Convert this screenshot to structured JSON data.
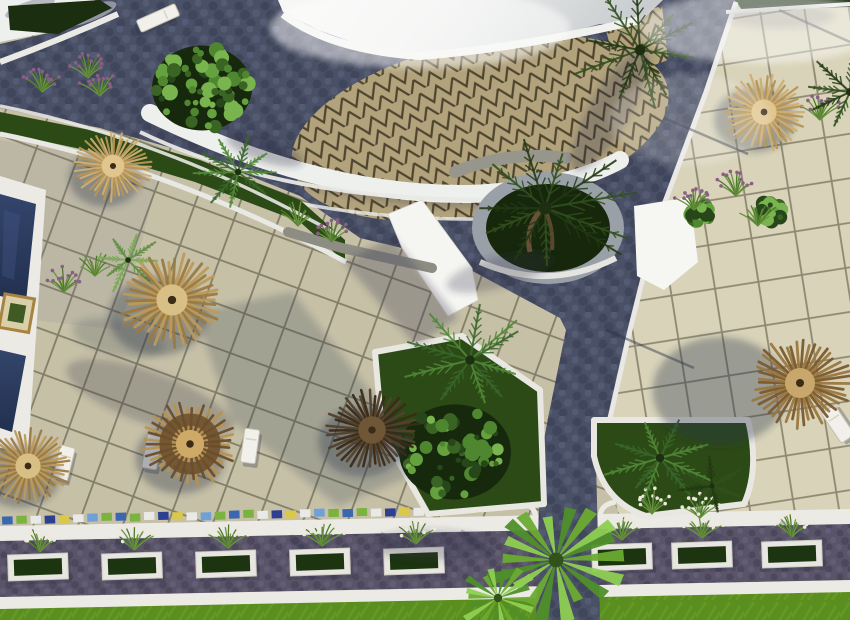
{
  "scene": {
    "title": "Aerial 3D architectural rendering of a resort courtyard with swimming pool, thatched palapa umbrellas, sun loungers, palm trees, tiled terraces, cobblestone paths and planted walkway",
    "type": "3d-architectural-render",
    "view": "aerial top-down",
    "canvas": {
      "width": 850,
      "height": 620
    }
  },
  "palette": {
    "sky_white": "#f7f7f5",
    "sky_gray": "#c6cacd",
    "tile_left": "#c6c0a7",
    "tile_right": "#d8d3b9",
    "tile_line": "#6b6651",
    "tile_line_right": "#7c7660",
    "cobble": "#4a5065",
    "cobble_dark": "#3c4257",
    "cobble_light": "#5d647f",
    "walkway": "#5a5468",
    "walkway_dark": "#49435a",
    "walkway_light": "#6a6480",
    "white_trim": "#eceae5",
    "zigzag_base": "#b2a37c",
    "zigzag_line": "#4e452f",
    "pool_water": "#2e4066",
    "pool_water_deep": "#22304f",
    "lawn": "#5a8e1e",
    "lawn_light": "#6ba42c",
    "bed_green": "#2c4a16",
    "bed_dark": "#16270c",
    "hedge": "#1b2e0f",
    "stone": "#97968d",
    "shadow": "#2a3048"
  },
  "objects": {
    "umbrella_tones": {
      "light": {
        "spokes": [
          "#cfae72",
          "#b69554"
        ],
        "hub": "#e0c58d"
      },
      "tan": {
        "spokes": [
          "#bd9a58",
          "#9a7a42"
        ],
        "hub": "#d8bf86"
      },
      "tanRing": {
        "spokes": [
          "#b8924f",
          "#6b4e2a"
        ],
        "hub": "#cfa968",
        "ring": true
      },
      "brown": {
        "spokes": [
          "#9a773f",
          "#7a5a2e"
        ],
        "hub": "#c8a76c"
      },
      "dark": {
        "spokes": [
          "#53412a",
          "#3a2b18"
        ],
        "hub": "#6e5636"
      }
    },
    "umbrellas": [
      {
        "x": 113,
        "y": 166,
        "r": 38,
        "tone": "light",
        "sx": -8,
        "sy": 12
      },
      {
        "x": 172,
        "y": 300,
        "r": 52,
        "tone": "tan",
        "sx": -14,
        "sy": 16
      },
      {
        "x": 28,
        "y": 466,
        "r": 42,
        "tone": "tan",
        "sx": -8,
        "sy": 10
      },
      {
        "x": 190,
        "y": 444,
        "r": 47,
        "tone": "tanRing",
        "sx": -10,
        "sy": 14
      },
      {
        "x": 372,
        "y": 430,
        "r": 46,
        "tone": "dark",
        "sx": -10,
        "sy": 12
      },
      {
        "x": 800,
        "y": 383,
        "r": 50,
        "tone": "brown",
        "sx": -80,
        "sy": 8,
        "sr": 1.35
      },
      {
        "x": 764,
        "y": 112,
        "r": 42,
        "tone": "light",
        "sx": -10,
        "sy": 8
      }
    ],
    "loungers": [
      {
        "x": 64,
        "y": 463,
        "rot": 14
      },
      {
        "x": 152,
        "y": 452,
        "rot": 10
      },
      {
        "x": 250,
        "y": 446,
        "rot": 8
      },
      {
        "x": 838,
        "y": 424,
        "rot": -34,
        "w": 16,
        "h": 36
      },
      {
        "x": 158,
        "y": 18,
        "rot": 66,
        "w": 13,
        "h": 42,
        "bench": true
      }
    ],
    "palm_tones": {
      "dark": [
        "#223a14",
        "#31501f"
      ],
      "mid": [
        "#3a662a",
        "#518738"
      ],
      "light": [
        "#5f8f43",
        "#7aac57"
      ],
      "bright": [
        "#6cab31",
        "#8ecf52"
      ]
    },
    "fan_colors": [
      "#6cab31",
      "#8ecf52",
      "#4e8f2a"
    ],
    "palms": [
      {
        "x": 545,
        "y": 208,
        "r": 92,
        "tone": "dark",
        "n": 11
      },
      {
        "x": 640,
        "y": 50,
        "r": 76,
        "tone": "dark",
        "n": 10
      },
      {
        "x": 850,
        "y": 92,
        "r": 56,
        "tone": "dark",
        "n": 8
      },
      {
        "x": 238,
        "y": 172,
        "r": 45,
        "tone": "mid",
        "n": 9
      },
      {
        "x": 128,
        "y": 260,
        "r": 40,
        "tone": "light",
        "n": 8
      },
      {
        "x": 470,
        "y": 360,
        "r": 68,
        "tone": "mid",
        "n": 10
      },
      {
        "x": 660,
        "y": 458,
        "r": 60,
        "tone": "mid",
        "n": 9
      },
      {
        "x": 712,
        "y": 486,
        "r": 38,
        "tone": "dark",
        "n": 7
      },
      {
        "x": 556,
        "y": 560,
        "r": 74,
        "tone": "bright",
        "type": "fan"
      },
      {
        "x": 498,
        "y": 598,
        "r": 42,
        "tone": "bright",
        "type": "fan"
      }
    ],
    "bush_colors": [
      "#27461a",
      "#3a6423",
      "#4f8630",
      "#65a13f",
      "#79b44e"
    ],
    "bushes": [
      {
        "x": 202,
        "y": 88,
        "r": 50
      },
      {
        "x": 455,
        "y": 452,
        "r": 56
      },
      {
        "x": 770,
        "y": 212,
        "r": 13
      },
      {
        "x": 700,
        "y": 214,
        "r": 11
      }
    ],
    "tuft_colors": {
      "purple": "#8a5f85",
      "white": "#ece8dc",
      "green": "#5d8c35",
      "stem": "#4e7a2b",
      "stem2": "#6b9440"
    },
    "tufts": [
      {
        "x": 42,
        "y": 92,
        "c": "purple"
      },
      {
        "x": 100,
        "y": 96,
        "c": "purple"
      },
      {
        "x": 88,
        "y": 78,
        "c": "purple"
      },
      {
        "x": 64,
        "y": 292,
        "c": "purple"
      },
      {
        "x": 95,
        "y": 276,
        "c": "green"
      },
      {
        "x": 298,
        "y": 226,
        "c": "green"
      },
      {
        "x": 332,
        "y": 242,
        "c": "purple"
      },
      {
        "x": 694,
        "y": 210,
        "c": "purple"
      },
      {
        "x": 736,
        "y": 196,
        "c": "purple"
      },
      {
        "x": 758,
        "y": 226,
        "c": "green"
      },
      {
        "x": 820,
        "y": 120,
        "c": "purple"
      },
      {
        "x": 652,
        "y": 514,
        "c": "white"
      },
      {
        "x": 700,
        "y": 518,
        "c": "white"
      },
      {
        "x": 40,
        "y": 552,
        "c": "white"
      },
      {
        "x": 134,
        "y": 550,
        "c": "white"
      },
      {
        "x": 228,
        "y": 548,
        "c": "white"
      },
      {
        "x": 322,
        "y": 546,
        "c": "white"
      },
      {
        "x": 416,
        "y": 544,
        "c": "white"
      },
      {
        "x": 622,
        "y": 540,
        "c": "white"
      },
      {
        "x": 702,
        "y": 538,
        "c": "white"
      },
      {
        "x": 792,
        "y": 537,
        "c": "white"
      }
    ],
    "planter_boxes": {
      "frame": "#e7e6e1",
      "soil": "#1d3410",
      "items": [
        {
          "x": 38,
          "y": 567
        },
        {
          "x": 132,
          "y": 566
        },
        {
          "x": 226,
          "y": 564
        },
        {
          "x": 320,
          "y": 562
        },
        {
          "x": 414,
          "y": 561
        },
        {
          "x": 622,
          "y": 557
        },
        {
          "x": 702,
          "y": 555
        },
        {
          "x": 792,
          "y": 554
        }
      ]
    },
    "mosaic": {
      "x1": 2,
      "y1": 516,
      "x2": 470,
      "y2": 506,
      "count": 34,
      "colors": [
        "#3b66b0",
        "#7ab33f",
        "#e9e9e7",
        "#2e3f8f",
        "#d9c84a",
        "#e9e9e7",
        "#6fa0d8",
        "#7ab33f"
      ]
    },
    "walkway_streaks": [
      30,
      115,
      200,
      290,
      380,
      460,
      620,
      700,
      780
    ]
  }
}
